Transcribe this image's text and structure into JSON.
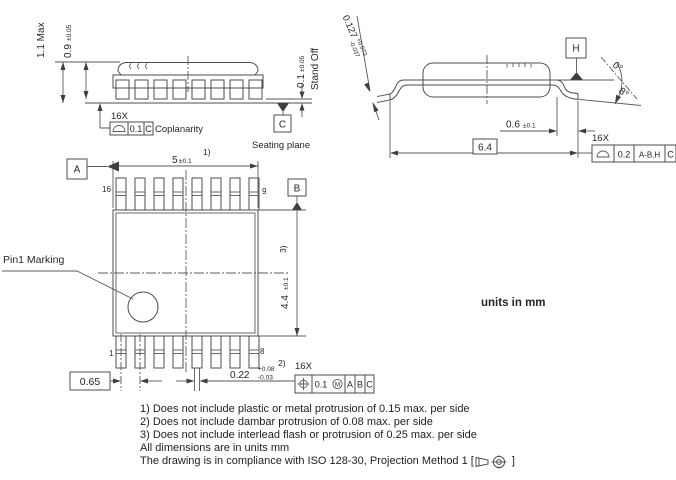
{
  "side_view": {
    "total_height": "1.1 Max",
    "body_thickness": "0.9",
    "body_thickness_tol": "±0.05",
    "standoff": "0.1",
    "standoff_tol": "±0.05",
    "standoff_label": "Stand Off",
    "lead_count": "16X",
    "coplanarity": {
      "tolerance": "0.1",
      "datum": "C",
      "label": "Coplanarity"
    },
    "seating": {
      "datum": "C",
      "label": "Seating plane"
    }
  },
  "end_view": {
    "lead_thickness": "0.127",
    "lead_thickness_plus": "+0.073",
    "lead_thickness_minus": "-0.037",
    "datum_h": "H",
    "angle_min": "0°",
    "angle_max": "8°",
    "foot_length": "0.6",
    "foot_length_tol": "±0.1",
    "overall_span": "6.4",
    "lead_count": "16X",
    "profile": {
      "tolerance": "0.2",
      "datums": "A-B,H",
      "datum2": "C"
    }
  },
  "top_view": {
    "datum_a": "A",
    "datum_b": "B",
    "body_width": "5",
    "body_width_tol": "±0.1",
    "body_width_note": "1)",
    "body_length": "4.4",
    "body_length_tol": "±0.1",
    "body_length_note": "3)",
    "pin_top_left": "16",
    "pin_top_right": "9",
    "pin_bottom_left": "1",
    "pin_bottom_right": "8",
    "pitch": "0.65",
    "lead_width": "0.22",
    "lead_width_plus": "+0.08",
    "lead_width_minus": "-0.03",
    "lead_width_note": "2)",
    "lead_count": "16X",
    "position": {
      "tolerance": "0.1",
      "modifier": "M",
      "datum1": "A",
      "datum2": "B",
      "datum3": "C"
    },
    "pin1_label": "Pin1 Marking"
  },
  "units_note": "units in mm",
  "notes": {
    "n1": "1) Does not include plastic or metal protrusion of 0.15 max. per side",
    "n2": "2) Does not include dambar protrusion of 0.08 max. per side",
    "n3": "3) Does not include interlead flash or protrusion of 0.25 max. per side",
    "n4": "All dimensions are in units mm",
    "n5_prefix": "The drawing is in compliance with ISO 128-30, Projection Method 1 [",
    "n5_suffix": "]"
  },
  "colors": {
    "line": "#4d4d4d",
    "text": "#262626",
    "background": "#ffffff"
  }
}
